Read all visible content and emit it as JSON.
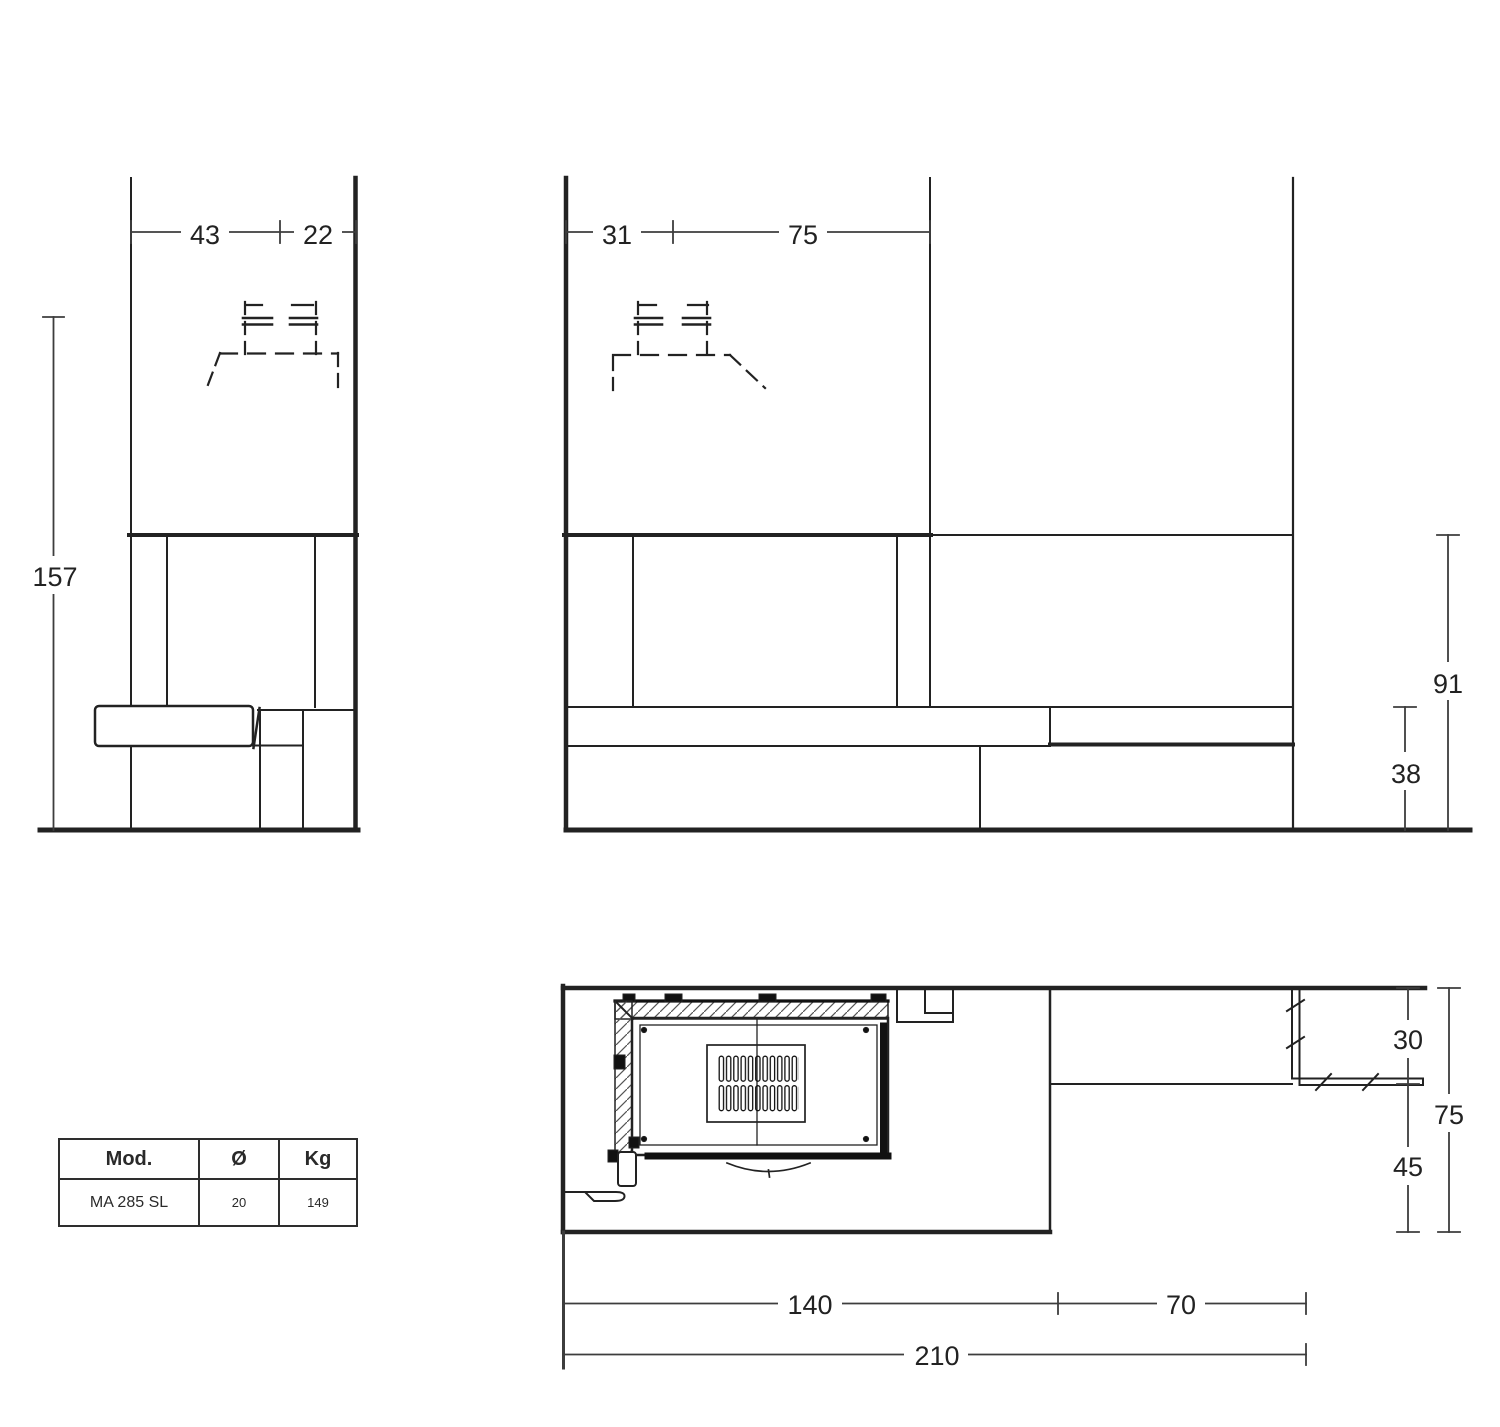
{
  "drawing_labels": {
    "side": {
      "w1": "43",
      "w2": "22",
      "h": "157"
    },
    "front": {
      "w1": "31",
      "w2": "75",
      "h1": "91",
      "h2": "38"
    },
    "plan": {
      "v1": "30",
      "v2": "75",
      "v3": "45",
      "b1": "140",
      "b2": "70",
      "b3": "210"
    }
  },
  "spec_table": {
    "header_model": "Mod.",
    "header_diameter": "Ø",
    "header_weight": "Kg",
    "model": "MA 285 SL",
    "diameter": "20",
    "weight": "149"
  }
}
